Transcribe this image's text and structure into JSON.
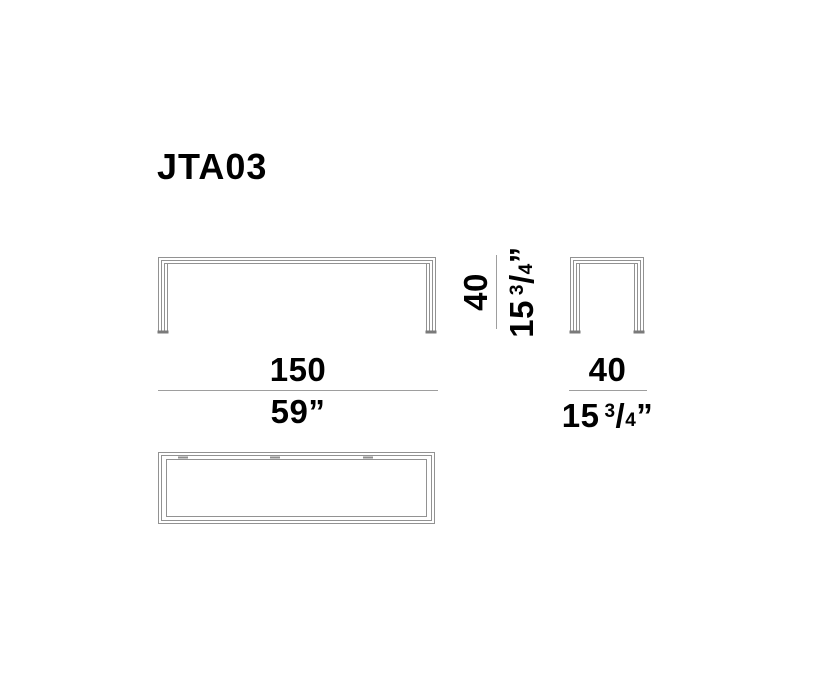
{
  "product": {
    "code": "JTA03"
  },
  "drawing": {
    "line_color": "#929292",
    "foot_color": "#7a7a7a",
    "divider_color": "#9e9e9e",
    "text_color": "#000000",
    "background_color": "#ffffff"
  },
  "dimensions": {
    "length": {
      "cm": "150",
      "inches": "59”"
    },
    "height": {
      "cm": "40",
      "inches_whole": "15",
      "fraction_numerator": "3",
      "fraction_slash": "/",
      "fraction_denominator": "4",
      "unit_mark": "”"
    },
    "depth": {
      "cm": "40",
      "inches_whole": "15",
      "fraction_numerator": "3",
      "fraction_slash": "/",
      "fraction_denominator": "4",
      "unit_mark": "”"
    }
  }
}
